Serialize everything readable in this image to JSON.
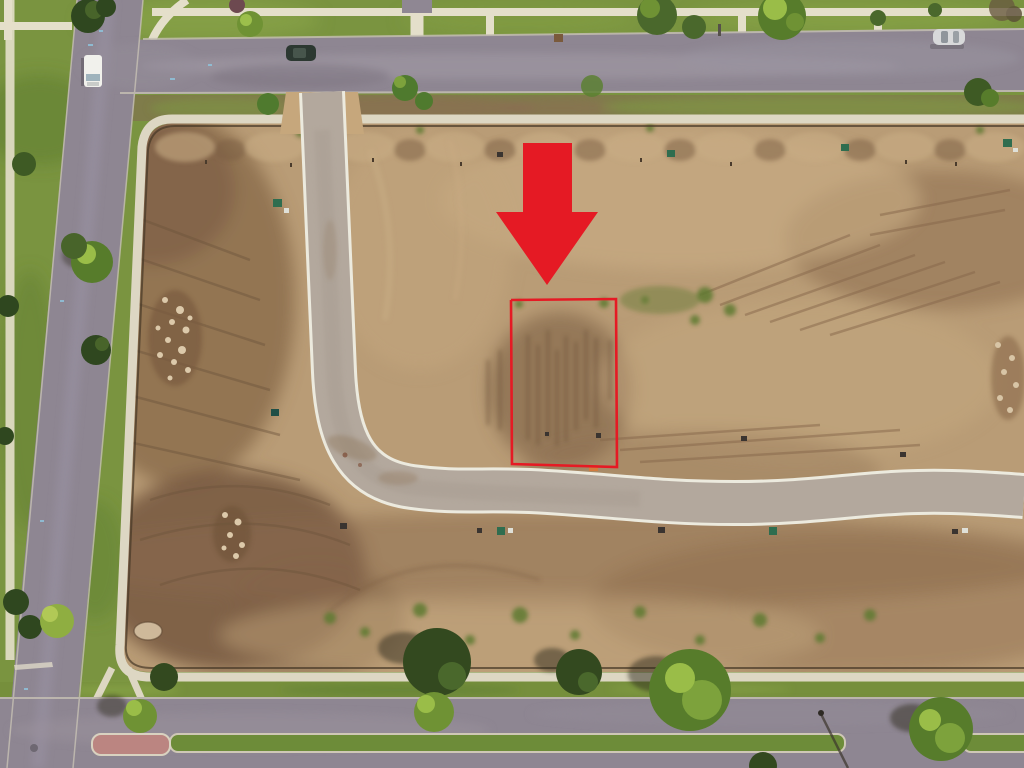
{
  "scene": {
    "kind": "aerial drone photograph",
    "subject": "graded vacant lots in a new residential subdivision under development",
    "annotation": {
      "arrow": "large red arrow pointing down at the advertised lot",
      "lot_outline": "red rectangle outlining the advertised vacant lot boundary"
    },
    "objects": {
      "vehicles": [
        {
          "name": "white-truck",
          "location": "left street"
        },
        {
          "name": "dark-car",
          "location": "top street near intersection"
        },
        {
          "name": "silver-car",
          "location": "top street, right side"
        }
      ],
      "roads": [
        "top street",
        "left street (diagonal)",
        "bottom boulevard with grass median",
        "new curved interior street"
      ],
      "site_features": [
        "bare graded dirt",
        "tire tracks",
        "rock piles",
        "utility boxes",
        "survey stakes",
        "perimeter sidewalk",
        "silt fence line",
        "street trees",
        "brick median end",
        "street light"
      ]
    }
  },
  "colors": {
    "annotation_red": "#e51a24",
    "grass": "#7a9440",
    "dirt_light": "#b99c76",
    "asphalt": "#8e8692",
    "concrete_road": "#b3a89d",
    "road_edge_line": "#eceade",
    "sidewalk": "#ddd7c3",
    "park_sidewalk": "#e4dfca",
    "silt_fence": "#463827",
    "median_grass": "#6d8c39",
    "brick_pad": "#bb8581"
  }
}
